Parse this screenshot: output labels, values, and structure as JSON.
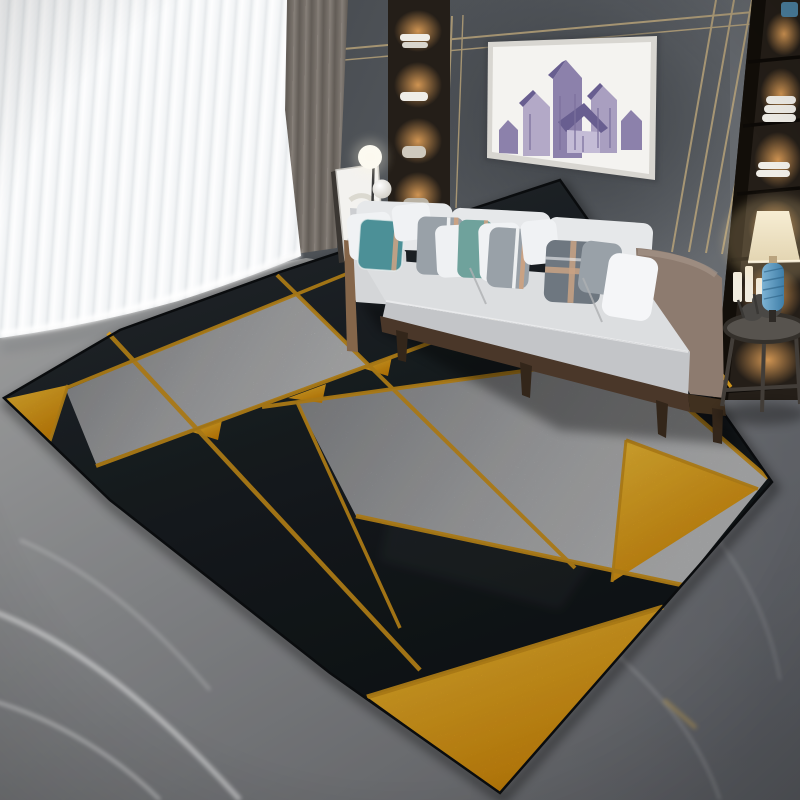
{
  "scene": {
    "setting": "modern living room product photo of a geometric area rug",
    "objects": [
      "sheer-white-curtains",
      "gray-curtain-panel",
      "paneled-wall-gold-trim",
      "framed-artwork-abstract-houses",
      "built-in-display-shelves",
      "three-seat-gray-sofa",
      "throw-pillows",
      "leaning-canvas",
      "double-globe-floor-lamp",
      "round-side-table",
      "blue-table-lamp",
      "pillar-candles",
      "black-gray-gold-geometric-rug",
      "gray-marble-floor"
    ],
    "rug_pieces": [
      "black-base",
      "upper-left-gray-band",
      "central-gray-band",
      "left-corner-yellow-triangle",
      "right-yellow-triangle",
      "bottom-yellow-triangle",
      "gold-cross-lines",
      "small-yellow-accents"
    ]
  },
  "palette": {
    "wall_light": "#696d72",
    "wall_dark": "#44484d",
    "gold_trim": "#c3ab7c",
    "art_canvas": "#f4f3f0",
    "art_frame": "#d8d6d1",
    "art_purple_light": "#b3a9c7",
    "art_purple_mid": "#8c81ab",
    "art_purple_dark": "#685e90",
    "curtain_white": "#fdfdfe",
    "curtain_white_shade": "#dfe3e6",
    "curtain_gray_1": "#9a938c",
    "curtain_gray_2": "#6b655f",
    "shelf_dark": "#241e18",
    "shelf_glow": "#d89a55",
    "towel_white": "#efede7",
    "candle_white": "#f1ecdf",
    "marble_light": "#cbcccc",
    "marble_mid": "#a3a5a8",
    "marble_dark": "#77797e",
    "rug_black_hi": "#2d3439",
    "rug_black": "#111518",
    "rug_gray_light": "#c8c9ca",
    "rug_gray": "#8e9093",
    "rug_yellow_light": "#ffc93a",
    "rug_yellow_deep": "#dd8f08",
    "rug_gold": "#d89b1d",
    "sofa_light": "#e0e2e4",
    "sofa_mid": "#ccced1",
    "sofa_front": "#c3c5c8",
    "sofa_arm_taupe": "#8d7b6f",
    "wood_light": "#85664a",
    "wood_dark": "#4a3729",
    "pillow_white": "#f0f2f4",
    "pillow_teal": "#4c9097",
    "pillow_sage": "#6fa29c",
    "pillow_gray": "#99a1a8",
    "pillow_charcoal": "#6e7780",
    "pillow_tan": "#c9a284",
    "lamp_shade_light": "#f7edd3",
    "lamp_shade": "#e3d5b2",
    "lamp_blue_light": "#7db3d4",
    "lamp_blue": "#3f7ea8",
    "globe_white": "#fbfaf5",
    "table_frame": "#423d38"
  }
}
